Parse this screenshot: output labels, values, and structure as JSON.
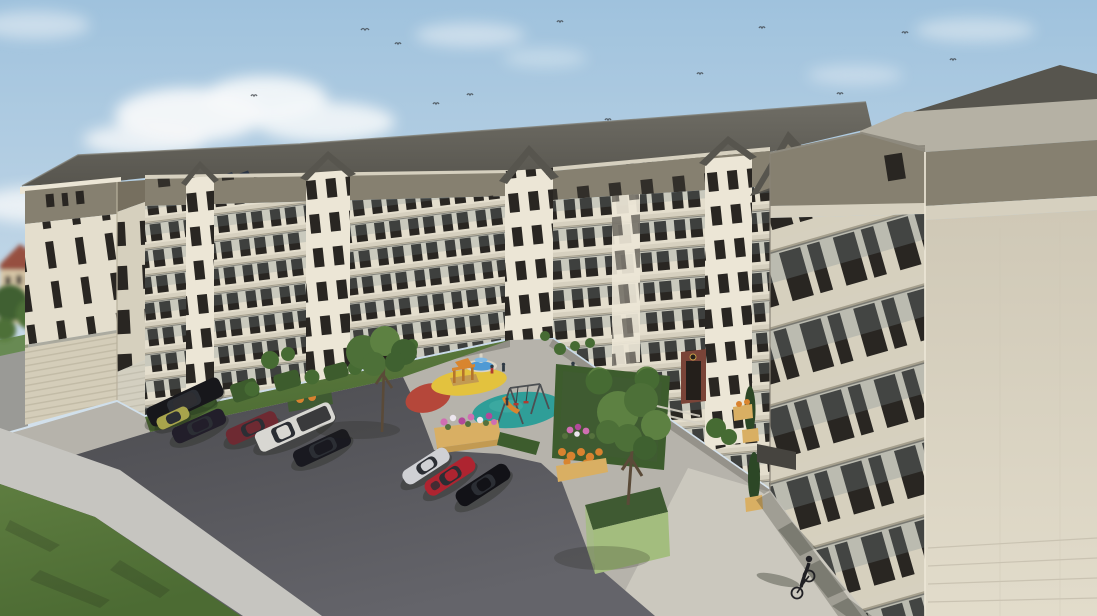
{
  "scene": {
    "description": "3D architectural rendering of a U-shaped six-storey cream apartment complex viewed from above: dark hipped roofs with solar panels and gabled bays, balconies with glass railings, a landscaped courtyard with fountain, yellow and teal playground circles with swing set and climbing frame, flower planters, hedges and trees, two rows of parked cars on dark asphalt, a lawn with sidewalk at lower left, an old red-roofed building in the far left background, and a cyclist on the sunlit walkway at lower right under a blue sky with clouds and distant birds."
  },
  "objects": {
    "building": {
      "floors_visible": 6,
      "features": [
        "balconies",
        "glass-railings",
        "solar-panels",
        "gabled-bays",
        "brick-entrance-portal"
      ]
    },
    "playground": {
      "circles": [
        "red",
        "yellow",
        "teal"
      ],
      "equipment": [
        "fountain",
        "climbing-frame",
        "swing-set",
        "slide"
      ],
      "figures": 3
    },
    "cars": [
      {
        "name": "black-suv",
        "color": "#17171b"
      },
      {
        "name": "lime-hatchback",
        "color": "#a8a44c"
      },
      {
        "name": "dark-wagon",
        "color": "#221e2a"
      },
      {
        "name": "maroon-hatchback",
        "color": "#6e2a32"
      },
      {
        "name": "white-pickup",
        "color": "#d8d7d2"
      },
      {
        "name": "black-wagon",
        "color": "#191920"
      },
      {
        "name": "silver-coupe",
        "color": "#cfd0d4"
      },
      {
        "name": "red-coupe",
        "color": "#ae2430"
      },
      {
        "name": "black-coupe",
        "color": "#121217"
      }
    ],
    "people": [
      {
        "name": "cyclist",
        "location": "lower-right walkway"
      }
    ],
    "planters": [
      "pink-white-flower-box",
      "orange-flower-bed",
      "orange-flower-cart",
      "green-tree-box",
      "cypress-pots"
    ]
  },
  "colors": {
    "skyTop": "#9fc2dd",
    "skyBot": "#e9eef2",
    "cloud": "#f6f8f9",
    "roof": "#57554e",
    "roofLight": "#6f6d65",
    "corniceLight": "#b5b1a4",
    "corniceShadow": "#8e8a7e",
    "attic": "#868070",
    "atticDark": "#766f5f",
    "wall": "#e4decd",
    "wallLight": "#ece6d6",
    "wallShade": "#d6d0be",
    "wallRight": "#cfc8b6",
    "wallRightLight": "#e2dccb",
    "slab": "#d6d0bf",
    "slabEdge": "#a59f8d",
    "win": "#292622",
    "glass": "#7d8c90",
    "rail": "#5c5c57",
    "base1": "#d4cdb9",
    "base2": "#c2bba6",
    "portal": "#7a4438",
    "portalDark": "#241f1b",
    "emblem": "#caa24a",
    "ground": "#b6b3ab",
    "groundLight": "#cbc8be",
    "asphalt1": "#64646a",
    "asphalt2": "#4a4a4e",
    "sidewalk": "#c6c5c0",
    "roadFar": "#9a9a96",
    "lawn1": "#5e7d40",
    "lawn2": "#4c6b33",
    "treeDark": "#3f6130",
    "treeMid": "#4d7038",
    "treeLight": "#5d8142",
    "hedge": "#3d5c2d",
    "cypress": "#2c4726",
    "bush": "#466b33",
    "boxWood": "#d9af63",
    "boxWood2": "#c29a52",
    "boxGreen": "#a3bd7e",
    "soil": "#3f5a32",
    "flowerPink": "#cf6fb2",
    "flowerWhite": "#ece6ee",
    "flowerMagenta": "#b2499a",
    "flowerOrange": "#d9822f",
    "flowerLeaf": "#55713d",
    "playYellow": "#e3c23e",
    "playTeal": "#2f9e98",
    "playTealLight": "#45b0a8",
    "playRed": "#b5473a",
    "fountainRim": "#d9d4c6",
    "fountainWater": "#4f9ad4",
    "fountainInner": "#7fb9e4",
    "metal": "#4c4f52",
    "slideOrange": "#d8852f",
    "frameOrange": "#b5742c",
    "kidRed": "#b03a30",
    "kidDark": "#2f3a44",
    "shadow": "#1e2118",
    "carSuv": "#17171b",
    "carLime": "#a8a44c",
    "carWagon": "#221e2a",
    "carMaroon": "#6e2a32",
    "carPickup": "#d8d7d2",
    "carPickupBed": "#3a3a3c",
    "carBlackWagon": "#191920",
    "carSilver": "#cfd0d4",
    "carRed": "#ae2430",
    "carBlack": "#121217",
    "carGlass": "#2b2e34",
    "cyclist": "#202024",
    "bird": "#3a3f44",
    "trunk": "#5a4a38",
    "oldWall": "#d9c9a9",
    "oldRoof": "#965040",
    "solar": "#2c3646"
  }
}
